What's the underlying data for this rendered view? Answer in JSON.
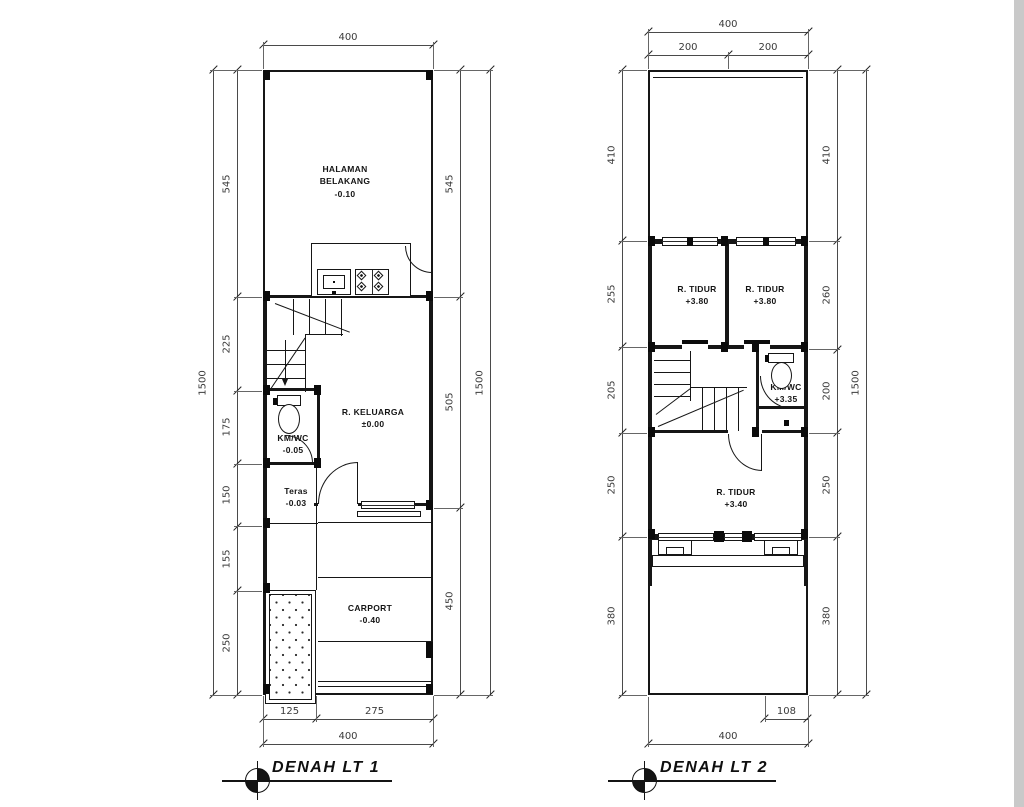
{
  "colors": {
    "wall": "#161616",
    "dim_line": "#4a4a4a",
    "dim_text": "#3b3b3b",
    "background": "#ffffff",
    "window_edge": "#c9c9c9"
  },
  "titles": {
    "plan1": "DENAH LT 1",
    "plan2": "DENAH LT 2"
  },
  "plan1": {
    "halaman": {
      "l1": "HALAMAN",
      "l2": "BELAKANG",
      "l3": "-0.10"
    },
    "dapur": {
      "l1": "DAPUR",
      "l2": "-0.03"
    },
    "keluarga": {
      "l1": "R. KELUARGA",
      "l2": "±0.00"
    },
    "kmwc": {
      "l1": "KM/WC",
      "l2": "-0.05"
    },
    "teras": {
      "l1": "Teras",
      "l2": "-0.03"
    },
    "taman": {
      "l1": "TAMAN",
      "l2": "-0.30"
    },
    "carport": {
      "l1": "CARPORT",
      "l2": "-0.40"
    }
  },
  "plan2": {
    "tidur1": {
      "l1": "R. TIDUR",
      "l2": "+3.80"
    },
    "tidur2": {
      "l1": "R. TIDUR",
      "l2": "+3.80"
    },
    "kmwc": {
      "l1": "KM/WC",
      "l2": "+3.35"
    },
    "tidur3": {
      "l1": "R. TIDUR",
      "l2": "+3.40"
    }
  },
  "dims": {
    "p1_top": {
      "values": [
        400
      ]
    },
    "p1_left_outer": {
      "values": [
        1500
      ]
    },
    "p1_left_inner": {
      "values": [
        545,
        225,
        175,
        150,
        155,
        250
      ]
    },
    "p1_right_inner": {
      "values": [
        545,
        505,
        450
      ]
    },
    "p1_right_outer": {
      "values": [
        1500
      ]
    },
    "p1_bottom_inner": {
      "values": [
        125,
        275
      ]
    },
    "p1_bottom_outer": {
      "values": [
        400
      ]
    },
    "p2_top_outer": {
      "values": [
        400
      ]
    },
    "p2_top_inner": {
      "values": [
        200,
        200
      ]
    },
    "p2_left": {
      "values": [
        410,
        255,
        205,
        250,
        380
      ]
    },
    "p2_right_inner": {
      "values": [
        410,
        260,
        200,
        250,
        380
      ]
    },
    "p2_right_outer": {
      "values": [
        1500
      ]
    },
    "p2_bottom_inner": {
      "values": [
        108
      ],
      "start": 292
    },
    "p2_bottom_outer": {
      "values": [
        400
      ]
    }
  }
}
